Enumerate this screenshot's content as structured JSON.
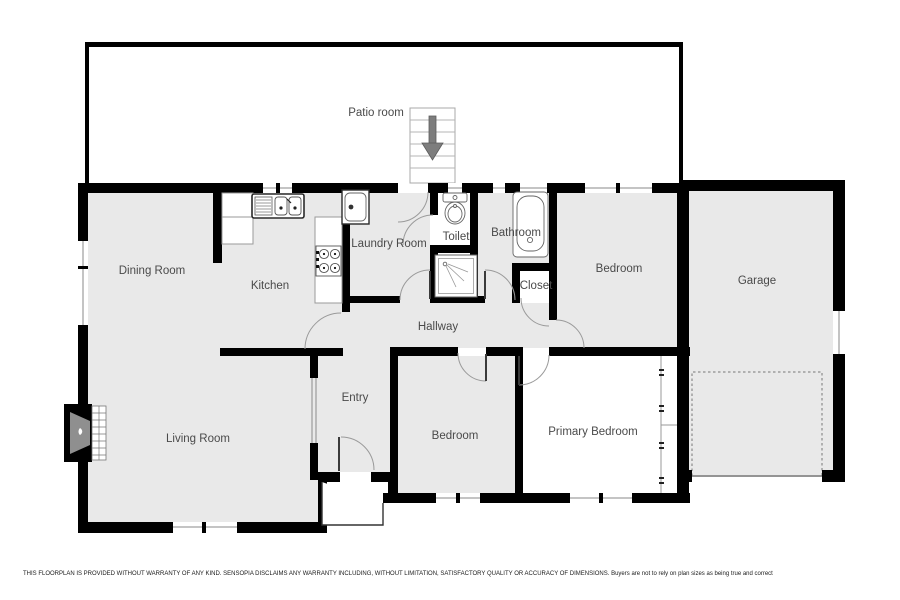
{
  "rooms": {
    "patio": "Patio room",
    "dining": "Dining Room",
    "kitchen": "Kitchen",
    "laundry": "Laundry Room",
    "toilet": "Toilet",
    "bathroom": "Bathroom",
    "bedroom_top": "Bedroom",
    "garage": "Garage",
    "closet": "Closet",
    "hallway": "Hallway",
    "entry": "Entry",
    "living": "Living Room",
    "bedroom_mid": "Bedroom",
    "primary": "Primary Bedroom"
  },
  "disclaimer": "THIS FLOORPLAN IS PROVIDED WITHOUT WARRANTY OF ANY KIND. SENSOPIA DISCLAIMS ANY WARRANTY INCLUDING, WITHOUT LIMITATION, SATISFACTORY QUALITY OR ACCURACY OF DIMENSIONS. Buyers are not to rely on plan sizes as being true and correct",
  "colors": {
    "wall": "#000000",
    "floor": "#e9e9e9",
    "white_floor": "#ffffff",
    "label": "#4a4a4a",
    "door_arc": "#9a9a9a",
    "stairs_arrow": "#7d7d7d"
  },
  "icons": {
    "stairs_arrow": "down-arrow",
    "fireplace": "flame"
  }
}
